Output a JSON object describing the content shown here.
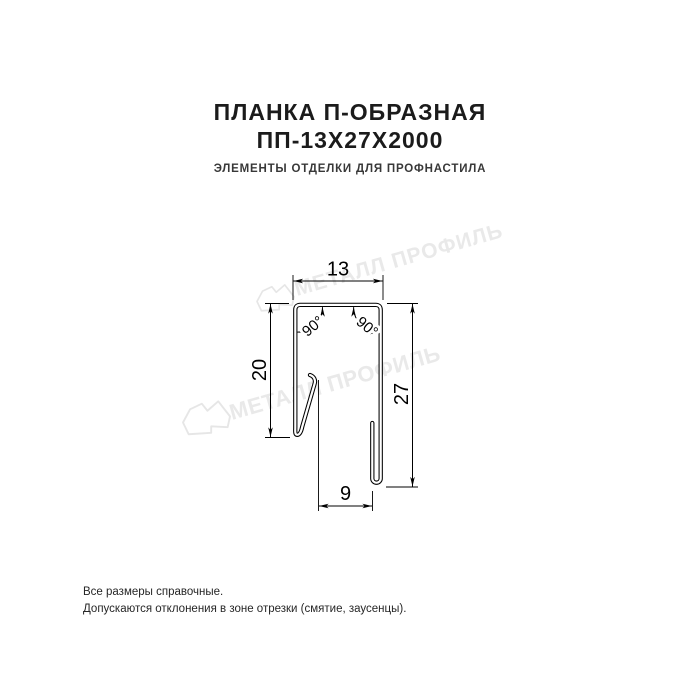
{
  "page": {
    "title_line1": "ПЛАНКА П-ОБРАЗНАЯ",
    "title_line2": "ПП-13Х27Х2000",
    "subtitle": "ЭЛЕМЕНТЫ ОТДЕЛКИ ДЛЯ ПРОФНАСТИЛА"
  },
  "drawing": {
    "type": "technical-profile-cross-section",
    "product": "U-shaped strip 13x27 mm",
    "line_color": "#000000",
    "dims": {
      "top_width": "13",
      "left_height": "20",
      "right_height": "27",
      "bottom_width": "9",
      "angle_left": "90°",
      "angle_right": "90°"
    }
  },
  "watermark": {
    "text": "МЕТАЛЛ ПРОФИЛЬ",
    "color": "#e9e9e9"
  },
  "footer": {
    "line1": "Все размеры справочные.",
    "line2": "Допускаются отклонения в зоне отрезки (смятие, заусенцы)."
  }
}
